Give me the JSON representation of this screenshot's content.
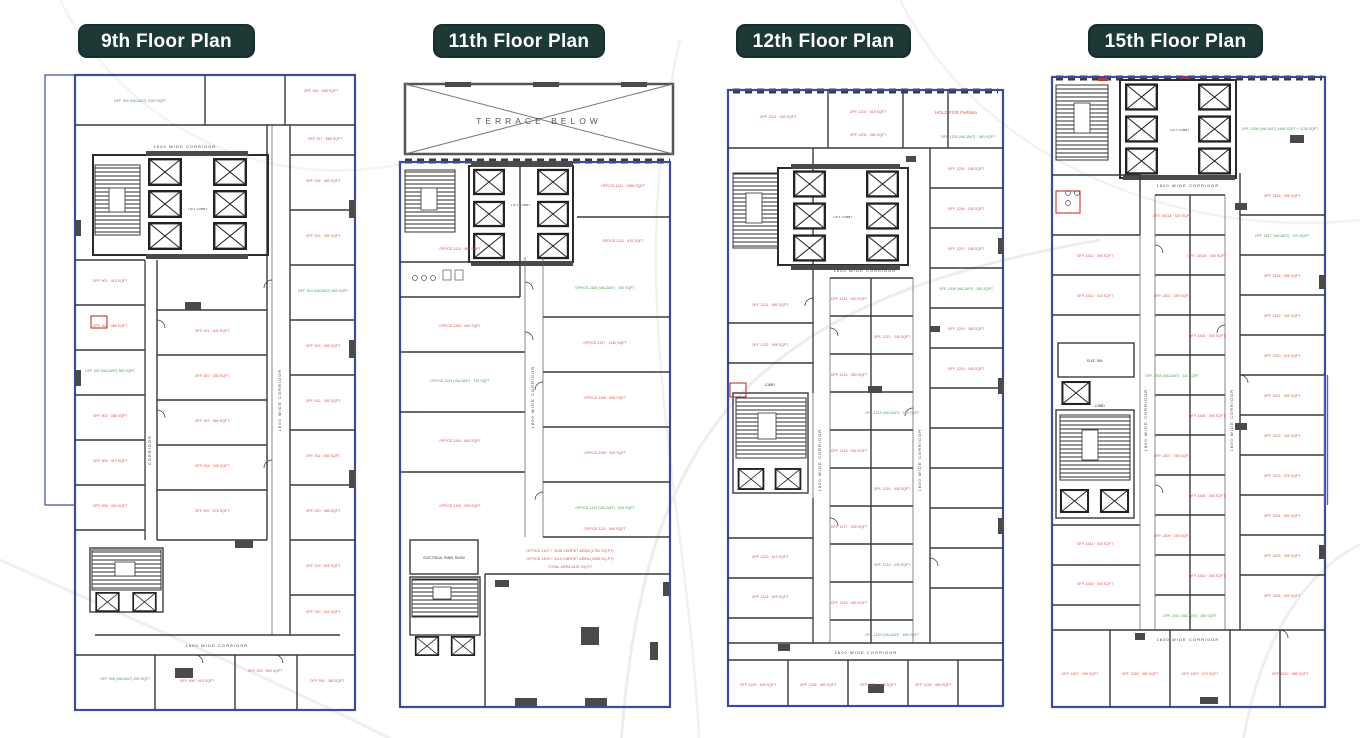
{
  "colors": {
    "badge_bg": "#1d3936",
    "boundary_blue": "#3e4a9e",
    "wall_dark": "#3a3a3a",
    "label_red": "#d9534f",
    "label_green": "#4a9e52",
    "terrace_gray": "#555555"
  },
  "panels": [
    {
      "title": "9th Floor Plan",
      "corridor_label": "1800 WIDE CORRIDOR",
      "side_corridor_label": "CORRIDOR",
      "lift_lobby": "LIFT LOBBY",
      "rooms": [
        "OFF. 900 (VACANT) 1050 SQFT",
        "OFF. 918 · 645 SQFT",
        "OFF. 917 · 665 SQFT",
        "OFF. 916 · 450 SQFT",
        "OFF. 915 · 450 SQFT",
        "OFF. 914 (VACANT) 465 SQFT",
        "OFF. 913 · 450 SQFT",
        "OFF. 912 · 450 SQFT",
        "OFF. 911 · 465 SQFT",
        "OFF. 910 · 480 SQFT",
        "OFF. 901 · 410 SQFT",
        "OFF. 902 · 385 SQFT",
        "OFF. 903 (VACANT) 390 SQFT",
        "OFF. 904 · 385 SQFT",
        "OFF. 905 · 410 SQFT",
        "OFF. 906 · 420 SQFT",
        "OFF. 921 · 340 SQFT",
        "OFF. 922 · 355 SQFT",
        "OFF. 923 · 360 SQFT",
        "OFF. 924 · 345 SQFT",
        "OFF. 907 · 575 SQFT",
        "OFF. 908 (VACANT) 390 SQFT",
        "OFF. 919 · 505 SQFT",
        "OFF. 920 · 520 SQFT",
        "OFF. 909 · 410 SQFT",
        "OFF. 925 · 600 SQFT",
        "OFF. 926 · 380 SQFT"
      ]
    },
    {
      "title": "11th Floor Plan",
      "terrace": "TERRACE BELOW",
      "corridor_label": "1800 WIDE CORRIDOR",
      "lift_lobby": "LIFT LOBBY",
      "electrical": "ELECTRICAL PANEL ROOM",
      "annotation": [
        "OFFICE-1107 + 1108 CARPET AREA (2781 SQ.FT)",
        "OFFICE-1109 + 1110 CARPET AREA (2350 SQ.FT)",
        "TOTAL AREA 5131 SQ.FT"
      ],
      "rooms": [
        "OFFICE-1101 · 2485 SQFT",
        "OFFICE-1102 · 640 SQFT",
        "OFFICE-1103 (VACANT) · 715 SQFT",
        "OFFICE-1104 · 860 SQFT",
        "OFFICE-1105 · 920 SQFT",
        "OFFICE-1106 (VACANT) · 780 SQFT",
        "OFFICE-1107 · 1140 SQFT",
        "OFFICE-1108 · 655 SQFT",
        "OFFICE-1109 · 600 SQFT",
        "OFFICE-1110 (VACANT) · 925 SQFT",
        "OFFICE-1111 · 540 SQFT",
        "OFFICE-1112 · 610 SQFT",
        "OFFICE-1113 · 585 SQFT"
      ]
    },
    {
      "title": "12th Floor Plan",
      "corridor_label": "1800 WIDE CORRIDOR",
      "lift_lobby": "LIFT LOBBY",
      "lobby_text": "LOBBY",
      "hold_note": "HOLD FOR Partition",
      "rooms": [
        "OFF. 1201 · 430 SQFT",
        "OFF. 1202 · 415 SQFT",
        "OFF. 1203 (VACANT) · 390 SQFT",
        "OFF. 1204 · 360 SQFT",
        "OFF. 1205 · 345 SQFT",
        "OFF. 1206 · 330 SQFT",
        "OFF. 1207 · 345 SQFT",
        "OFF. 1208 (VACANT) · 350 SQFT",
        "OFF. 1209 · 365 SQFT",
        "OFF. 1210 · 340 SQFT",
        "OFF. 1211 · 330 SQFT",
        "OFF. 1212 · 345 SQFT",
        "OFF. 1213 · 360 SQFT",
        "OFF. 1214 (VACANT) · 375 SQFT",
        "OFF. 1215 · 390 SQFT",
        "OFF. 1216 · 405 SQFT",
        "OFF. 1217 · 420 SQFT",
        "OFF. 1218 · 435 SQFT",
        "OFF. 1219 · 450 SQFT",
        "OFF. 1220 (VACANT) · 465 SQFT",
        "OFF. 1221 · 480 SQFT",
        "OFF. 1222 · 495 SQFT",
        "OFF. 1223 · 510 SQFT",
        "OFF. 1224 · 525 SQFT",
        "OFF. 1225 · 540 SQFT",
        "OFF. 1226 · 450 SQFT",
        "OFF. 1227 · 465 SQFT",
        "OFF. 1228 · 480 SQFT"
      ]
    },
    {
      "title": "15th Floor Plan",
      "corridor_label": "1800 WIDE CORRIDOR",
      "lift_lobby": "LIFT LOBBY",
      "lobby_text": "LOBBY",
      "elec": "ELEC. RM.",
      "rooms": [
        "OFF. 1506 (VACANT) 1496 SQFT + 1136 SQFT",
        "OFF. 1501A · 320 SQFT",
        "OFF. 1501B · 305 SQFT",
        "OFF. 1502 · 290 SQFT",
        "OFF. 1503 · 305 SQFT",
        "OFF. 1504 (VACANT) · 310 SQFT",
        "OFF. 1505 · 295 SQFT",
        "OFF. 1507 · 280 SQFT",
        "OFF. 1508 · 265 SQFT",
        "OFF. 1509 · 250 SQFT",
        "OFF. 1510 · 265 SQFT",
        "OFF. 1511 (VACANT) · 280 SQFT",
        "OFF. 1512 · 295 SQFT",
        "OFF. 1513 · 310 SQFT",
        "OFF. 1514 · 325 SQFT",
        "OFF. 1515 · 340 SQFT",
        "OFF. 1516 · 355 SQFT",
        "OFF. 1517 (VACANT) · 370 SQFT",
        "OFF. 1518 · 385 SQFT",
        "OFF. 1519 · 400 SQFT",
        "OFF. 1520 · 415 SQFT",
        "OFF. 1521 · 430 SQFT",
        "OFF. 1522 · 340 SQFT",
        "OFF. 1523 · 375 SQFT",
        "OFF. 1524 · 390 SQFT",
        "OFF. 1525 · 405 SQFT",
        "OFF. 1526 · 420 SQFT",
        "OFF. 1527 · 345 SQFT",
        "OFF. 1528 · 360 SQFT",
        "OFF. 1529 · 375 SQFT",
        "OFF. 1530 · 480 SQFT"
      ]
    }
  ]
}
